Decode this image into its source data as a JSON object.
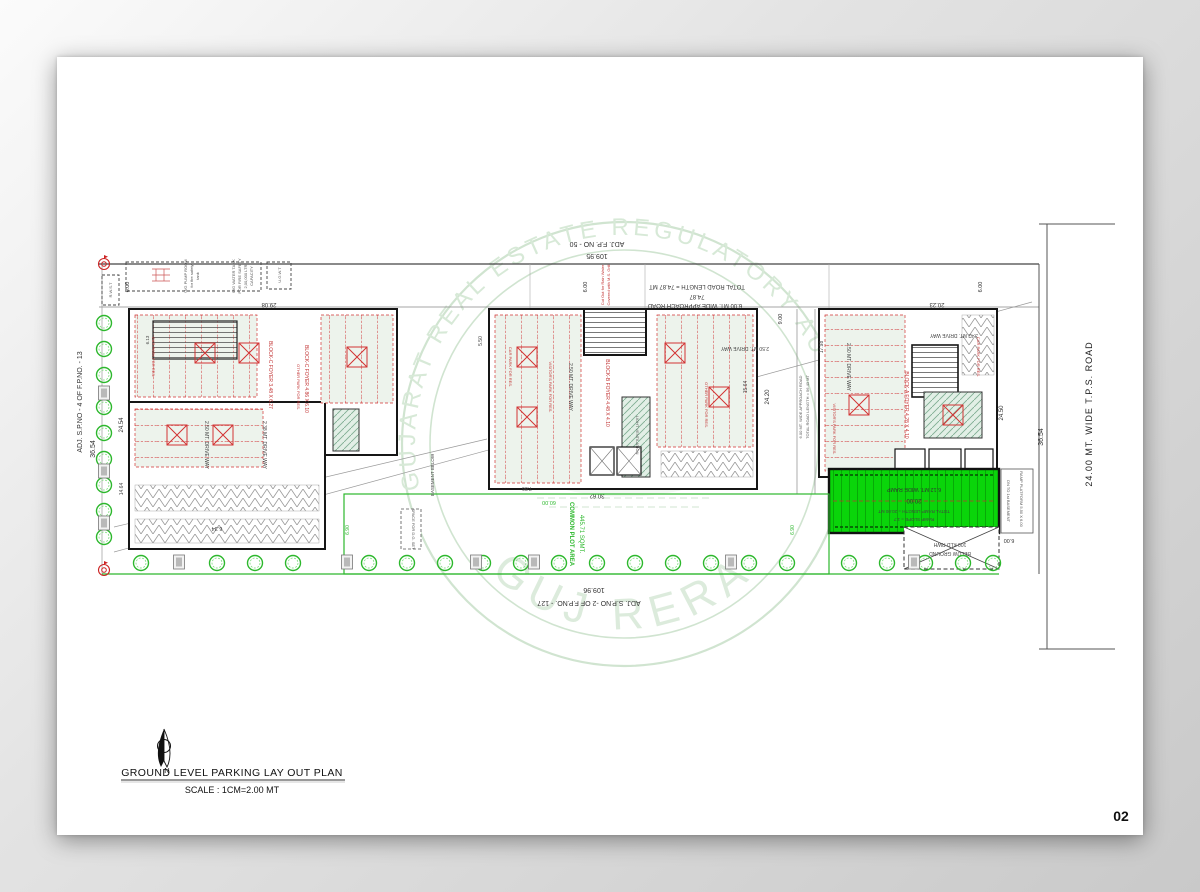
{
  "page": {
    "number": "02"
  },
  "title_block": {
    "title": "GROUND LEVEL  PARKING LAY OUT PLAN",
    "scale": "SCALE : 1CM=2.00 MT",
    "north": "N"
  },
  "watermark": {
    "arc": "GUJARAT REAL ESTATE REGULATORY AUTHORITY",
    "name": "GUJ RERA"
  },
  "boundary": {
    "left_adj": "ADJ. S.P.NO - 4 OF  F.P.NO. - 13",
    "left_dim": "36.54",
    "right_road": "24.00 MT. WIDE T.P.S.  ROAD",
    "right_dim": "36.54",
    "top_adj": "ADJ.  F.P. NO - 50",
    "top_dim": "109.95",
    "bottom_dim": "109.96",
    "bottom_adj": "ADJ. S.P.NO -2 OF  F.P.NO. - 127"
  },
  "road": {
    "total": "TOTAL  ROAD LENGTH = 74.87 MT",
    "dim": "74.87",
    "label": "6.00 MT. WIDE APPROACH ROAD",
    "d600": "6.00",
    "d900": "9.00",
    "note1": "Cut Out for Rain Water",
    "note2": "Covered with M.S. Grill"
  },
  "side_road": {
    "label": "6.00 MT. WIDE APPROACH ROAD",
    "total": "TOTAL ROAD LENGTH = 56.43 MT",
    "d2420": "24.20",
    "d1564": "15.64"
  },
  "common_plot": {
    "line1": "COMMON PLOT AREA",
    "line2": "445.71 SQMT.",
    "d6000": "60.00",
    "d690": "6.90",
    "dg": "SPACE FOR D.G. SET",
    "basement": "BASEMENT BELOW"
  },
  "ramp": {
    "label": "6.12 MT. WIDE RAMP",
    "dim": "20.00",
    "total": "TOTAL RAMP LENGTH = 20.00 MT",
    "slope": "RAMP SLOPE = 1:7",
    "dn": "DN TO 1st BASEMENT",
    "platform": "RAMP PLATFORM 5.50 X 6.00",
    "d600": "6.00",
    "rwh1": "100 KLD RWH",
    "rwh2": "BELOW GROUND"
  },
  "utilities": {
    "pump1": "U/G PUMP ROOM",
    "pump2": "for fire safety",
    "pump3": "tank",
    "tank1": "U/G WATER TANK",
    "tank2": "FOR FIRE SAFETY",
    "tank3": "2,00,000 LTR.",
    "tank4": "CAPACITY",
    "ugwt": "U.G.W.T",
    "rwst": "R.W.S.T"
  },
  "blocks": {
    "c": {
      "foyer1": "BLOCK-C  FOYER  3.48 X 6.27",
      "foyer2": "BLOCK-C  FOYER  4.86 X 6.10",
      "d2908": "29.08",
      "d2454": "24.54",
      "d613": "6.13",
      "d1464": "14.64",
      "d634": "6.34",
      "drive1": "2.50 MT. DRIVE WAY",
      "drive2": "2.38 MT. DRIVE WAY",
      "park1": "CAR PARK FOR RES.",
      "park2": "OTHER PARK FOR RES."
    },
    "b": {
      "foyer": "BLOCK-B  FOYER  4.48 X 4.10",
      "d3062": "30.62",
      "d786": "7.86",
      "d550": "5.50",
      "drive1": "2.50 MT. DRIVE WAY",
      "drive2": "2.50 MT. DRIVE WAY",
      "park1": "CAR PARK FOR RES.",
      "park2": "VISITOR'S PARK FOR RES.",
      "park3": "OTHER PARK FOR RES.",
      "vent": "LIGHT VENTILATION"
    },
    "a": {
      "foyer": "BLOCK-A  FOYER  4.28 X 4.10",
      "d2023": "20.23",
      "d2450": "24.50",
      "d1798": "17.98",
      "drive1": "2.50 MT. DRIVE WAY",
      "drive2": "3.42 MT. DRIVE WAY",
      "park1": "VISITOR'S PARK FOR RES.",
      "park2": "CAR PARK FOR RES."
    }
  }
}
